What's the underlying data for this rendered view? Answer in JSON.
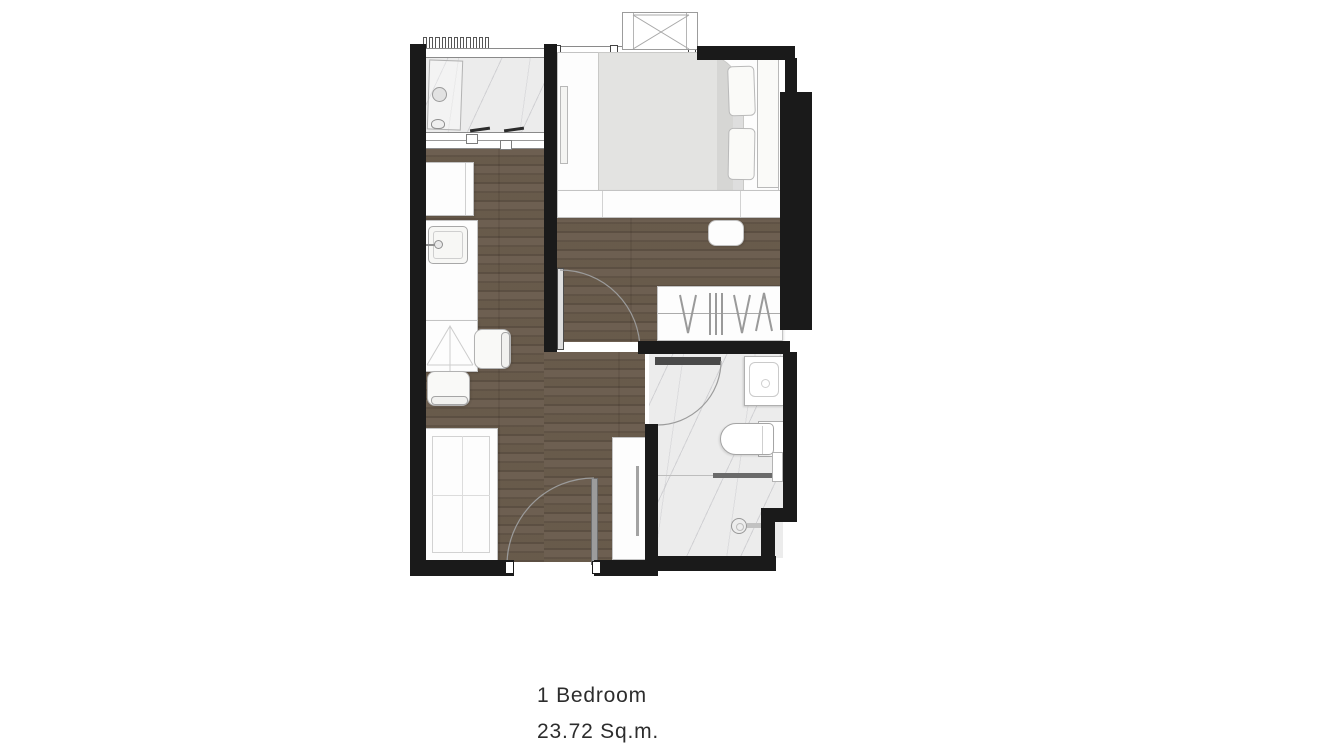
{
  "caption": {
    "unit_type": "1 Bedroom",
    "unit_area": "23.72 Sq.m."
  },
  "palette": {
    "background": "#ffffff",
    "wall": "#1a1a1a",
    "wood_floor": "#a2978b",
    "wood_floor_dark": "#8f8478",
    "marble_floor": "#ececec",
    "marble_vein": "#9a9aa0",
    "duvet": "#e3e3e1",
    "furniture_fill": "#fdfdfd",
    "furniture_outline": "#c3c3c3",
    "door_leaf_dark": "#4a4a4a",
    "door_leaf_mid": "#9c9c9c",
    "swing_arc": "#9b9b9b",
    "text": "#2d2d2d"
  }
}
